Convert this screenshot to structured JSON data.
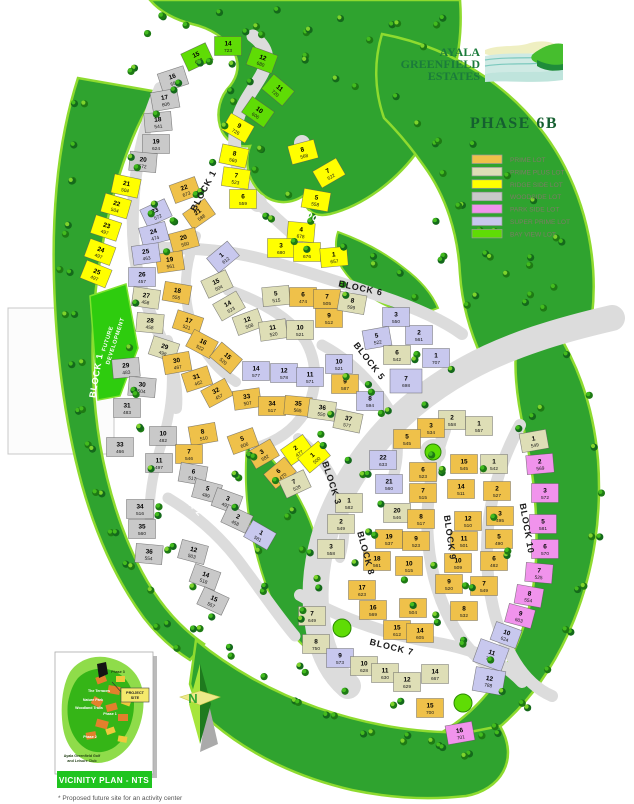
{
  "logo": {
    "line1": "AYALA",
    "line2": "GREENFIELD",
    "line3": "ESTATES"
  },
  "phase_title": "PHASE 6B",
  "legend": {
    "items": [
      {
        "key": "p",
        "label": "PRIME LOT",
        "color": "#EFC14A"
      },
      {
        "key": "pp",
        "label": "PRIME PLUS LOT",
        "color": "#DEDEB6"
      },
      {
        "key": "r",
        "label": "RIDGE SIDE LOT",
        "color": "#FFFF00"
      },
      {
        "key": "w",
        "label": "WOODSIDE LOT",
        "color": "#C9C9C9"
      },
      {
        "key": "pk",
        "label": "PARK SIDE LOT",
        "color": "#F193EC"
      },
      {
        "key": "sp",
        "label": "SUPER PRIME LOT",
        "color": "#C8C8EE"
      },
      {
        "key": "b",
        "label": "BAY VIEW LOT",
        "color": "#5FDC05"
      }
    ]
  },
  "compass": {
    "label": "N"
  },
  "footnote": "* Proposed future site for an activity center",
  "vicinity": {
    "banner": "VICINITY PLAN - NTS",
    "project_site_line1": "PROJECT",
    "project_site_line2": "SITE",
    "labels": [
      [
        "Phase 3",
        118,
        673,
        "#1d3a10"
      ],
      [
        "The Terraces",
        99,
        692,
        "#ffffff"
      ],
      [
        "Nature Park",
        93,
        701,
        "#ffffff"
      ],
      [
        "Woodland Trails",
        89,
        709,
        "#ffffff"
      ],
      [
        "Phase 1",
        110,
        715,
        "#ffffff"
      ],
      [
        "Phase 2",
        90,
        738,
        "#ffffff"
      ],
      [
        "Ayala Greenfield Golf",
        82,
        757,
        "#1d3a10"
      ],
      [
        "and Leisure Club",
        82,
        762,
        "#1d3a10"
      ]
    ]
  },
  "map": {
    "future_dev_line1": "FUTURE",
    "future_dev_line2": "DEVELOPMENT",
    "block_labels": [
      [
        "BLOCK 1",
        206,
        192,
        -62,
        "#1a1a1a"
      ],
      [
        "BLOCK 1",
        312,
        220,
        30,
        "#ffffff"
      ],
      [
        "BLOCK 1",
        99,
        376,
        -80,
        "#ffffff"
      ],
      [
        "BLOCK 6",
        360,
        291,
        12,
        "#1a1a1a"
      ],
      [
        "BLOCK 5",
        367,
        363,
        52,
        "#1a1a1a"
      ],
      [
        "BLOCK 2",
        184,
        500,
        48,
        "#ffffff"
      ],
      [
        "BLOCK 3",
        329,
        484,
        72,
        "#1a1a1a"
      ],
      [
        "BLOCK 8",
        363,
        554,
        75,
        "#1a1a1a"
      ],
      [
        "BLOCK 9",
        447,
        538,
        82,
        "#1a1a1a"
      ],
      [
        "BLOCK 10",
        524,
        529,
        80,
        "#1a1a1a"
      ],
      [
        "BLOCK 7",
        391,
        650,
        14,
        "#1a1a1a"
      ]
    ],
    "green_circle_lots": [
      [
        433,
        452,
        8
      ],
      [
        342,
        628,
        9
      ],
      [
        463,
        703,
        9
      ]
    ],
    "lots": [
      [
        "15",
        "688",
        "b",
        197,
        57,
        -25
      ],
      [
        "14",
        "723",
        "b",
        228,
        46,
        0
      ],
      [
        "12",
        "680",
        "b",
        262,
        60,
        20
      ],
      [
        "11",
        "720",
        "b",
        278,
        90,
        40
      ],
      [
        "10",
        "606",
        "b",
        258,
        112,
        35
      ],
      [
        "16",
        "680",
        "w",
        173,
        79,
        -18
      ],
      [
        "17",
        "606",
        "w",
        165,
        100,
        -10
      ],
      [
        "18",
        "541",
        "w",
        158,
        122,
        -5
      ],
      [
        "19",
        "624",
        "w",
        156,
        144,
        0
      ],
      [
        "20",
        "572",
        "w",
        143,
        162,
        5
      ],
      [
        "21",
        "504",
        "r",
        126,
        186,
        12
      ],
      [
        "22",
        "504",
        "r",
        116,
        206,
        16
      ],
      [
        "23",
        "497",
        "r",
        106,
        228,
        18
      ],
      [
        "24",
        "497",
        "r",
        100,
        252,
        20
      ],
      [
        "25",
        "497",
        "r",
        96,
        274,
        22
      ],
      [
        "9",
        "726",
        "r",
        238,
        128,
        30
      ],
      [
        "8",
        "569",
        "r",
        234,
        156,
        12
      ],
      [
        "7",
        "523",
        "r",
        236,
        178,
        8
      ],
      [
        "6",
        "559",
        "r",
        243,
        199,
        0
      ],
      [
        "8",
        "568",
        "r",
        303,
        152,
        -15
      ],
      [
        "7",
        "522",
        "r",
        329,
        173,
        -30
      ],
      [
        "5",
        "558",
        "r",
        316,
        200,
        10
      ],
      [
        "4",
        "678",
        "r",
        301,
        232,
        5
      ],
      [
        "3",
        "680",
        "r",
        281,
        248,
        0
      ],
      [
        "2",
        "676",
        "r",
        307,
        252,
        0
      ],
      [
        "1",
        "657",
        "r",
        334,
        257,
        -5
      ],
      [
        "22",
        "673",
        "p",
        185,
        190,
        -20
      ],
      [
        "21",
        "588",
        "p",
        199,
        214,
        -35
      ],
      [
        "20",
        "550",
        "p",
        184,
        240,
        -15
      ],
      [
        "19",
        "561",
        "p",
        170,
        262,
        -8
      ],
      [
        "18",
        "555",
        "p",
        177,
        293,
        10
      ],
      [
        "17",
        "521",
        "p",
        188,
        323,
        18
      ],
      [
        "16",
        "522",
        "p",
        202,
        344,
        28
      ],
      [
        "15",
        "520",
        "p",
        226,
        358,
        40
      ],
      [
        "23",
        "572",
        "sp",
        156,
        213,
        -25
      ],
      [
        "24",
        "474",
        "sp",
        154,
        234,
        -15
      ],
      [
        "25",
        "463",
        "sp",
        146,
        254,
        -8
      ],
      [
        "26",
        "457",
        "sp",
        142,
        277,
        0
      ],
      [
        "27",
        "458",
        "pp",
        146,
        298,
        8
      ],
      [
        "28",
        "458",
        "pp",
        150,
        323,
        5
      ],
      [
        "29",
        "498",
        "pp",
        164,
        349,
        18
      ],
      [
        "1",
        "612",
        "sp",
        223,
        257,
        -40
      ],
      [
        "15",
        "504",
        "pp",
        217,
        284,
        -25
      ],
      [
        "14",
        "523",
        "pp",
        229,
        306,
        -30
      ],
      [
        "12",
        "508",
        "pp",
        248,
        322,
        -20
      ],
      [
        "11",
        "520",
        "pp",
        273,
        330,
        -8
      ],
      [
        "10",
        "521",
        "pp",
        300,
        330,
        0
      ],
      [
        "5",
        "515",
        "pp",
        276,
        296,
        -5
      ],
      [
        "6",
        "474",
        "p",
        303,
        297,
        0
      ],
      [
        "7",
        "505",
        "p",
        327,
        299,
        0
      ],
      [
        "9",
        "512",
        "p",
        329,
        318,
        0
      ],
      [
        "8",
        "599",
        "pp",
        352,
        303,
        10
      ],
      [
        "30",
        "467",
        "p",
        177,
        363,
        -10
      ],
      [
        "31",
        "462",
        "p",
        197,
        379,
        -18
      ],
      [
        "32",
        "457",
        "p",
        217,
        393,
        -28
      ],
      [
        "33",
        "507",
        "p",
        247,
        399,
        -8
      ],
      [
        "34",
        "517",
        "p",
        272,
        406,
        0
      ],
      [
        "35",
        "565",
        "p",
        298,
        406,
        5
      ],
      [
        "36",
        "550",
        "pp",
        322,
        410,
        8
      ],
      [
        "37",
        "577",
        "pp",
        348,
        421,
        12
      ],
      [
        "14",
        "577",
        "sp",
        256,
        371,
        0
      ],
      [
        "12",
        "578",
        "sp",
        284,
        373,
        0
      ],
      [
        "11",
        "571",
        "sp",
        310,
        377,
        0
      ],
      [
        "29",
        "483",
        "w",
        126,
        368,
        -5
      ],
      [
        "30",
        "504",
        "w",
        142,
        387,
        5
      ],
      [
        "31",
        "483",
        "w",
        127,
        408,
        0
      ],
      [
        "33",
        "466",
        "w",
        120,
        447,
        0
      ],
      [
        "5",
        "522",
        "sp",
        377,
        338,
        -10
      ],
      [
        "2",
        "561",
        "sp",
        419,
        335,
        0
      ],
      [
        "6",
        "542",
        "pp",
        397,
        355,
        0
      ],
      [
        "1",
        "707",
        "sp",
        436,
        358,
        0
      ],
      [
        "10",
        "521",
        "sp",
        339,
        364,
        0
      ],
      [
        "9",
        "587",
        "p",
        345,
        384,
        0
      ],
      [
        "7",
        "698",
        "sp",
        406,
        381,
        0,
        32,
        24
      ],
      [
        "8",
        "594",
        "sp",
        370,
        401,
        0
      ],
      [
        "3",
        "550",
        "sp",
        396,
        317,
        0
      ],
      [
        "2",
        "558",
        "pp",
        452,
        420,
        0
      ],
      [
        "1",
        "557",
        "pp",
        479,
        426,
        0
      ],
      [
        "10",
        "482",
        "w",
        163,
        436,
        0
      ],
      [
        "8",
        "510",
        "p",
        203,
        434,
        -10
      ],
      [
        "7",
        "546",
        "p",
        189,
        454,
        0
      ],
      [
        "11",
        "497",
        "w",
        159,
        463,
        0
      ],
      [
        "6",
        "517",
        "w",
        193,
        474,
        10
      ],
      [
        "5",
        "489",
        "w",
        207,
        491,
        15
      ],
      [
        "3",
        "492",
        "w",
        227,
        501,
        20
      ],
      [
        "2",
        "458",
        "w",
        237,
        519,
        25
      ],
      [
        "1",
        "581",
        "sp",
        260,
        535,
        30
      ],
      [
        "34",
        "516",
        "w",
        140,
        509,
        0
      ],
      [
        "35",
        "560",
        "w",
        142,
        529,
        0
      ],
      [
        "36",
        "554",
        "w",
        149,
        554,
        5
      ],
      [
        "12",
        "503",
        "w",
        193,
        552,
        15
      ],
      [
        "14",
        "518",
        "w",
        205,
        577,
        20
      ],
      [
        "15",
        "557",
        "w",
        213,
        601,
        25
      ],
      [
        "5",
        "606",
        "p",
        243,
        441,
        -20
      ],
      [
        "3",
        "582",
        "p",
        263,
        454,
        -30
      ],
      [
        "6",
        "470",
        "p",
        280,
        473,
        -40
      ],
      [
        "2",
        "477",
        "r",
        297,
        450,
        -35
      ],
      [
        "1",
        "500",
        "r",
        314,
        457,
        -40
      ],
      [
        "7",
        "528",
        "pp",
        295,
        484,
        -25
      ],
      [
        "1",
        "582",
        "pp",
        349,
        503,
        0
      ],
      [
        "2",
        "549",
        "pp",
        341,
        524,
        0
      ],
      [
        "3",
        "558",
        "pp",
        331,
        549,
        0
      ],
      [
        "22",
        "633",
        "sp",
        383,
        460,
        0
      ],
      [
        "21",
        "560",
        "sp",
        389,
        484,
        0
      ],
      [
        "20",
        "546",
        "pp",
        397,
        513,
        0
      ],
      [
        "19",
        "537",
        "p",
        389,
        539,
        0
      ],
      [
        "18",
        "561",
        "p",
        377,
        561,
        0
      ],
      [
        "17",
        "623",
        "p",
        362,
        590,
        0
      ],
      [
        "3",
        "534",
        "p",
        431,
        428,
        0
      ],
      [
        "5",
        "545",
        "p",
        407,
        439,
        0
      ],
      [
        "6",
        "523",
        "p",
        423,
        472,
        0
      ],
      [
        "7",
        "515",
        "p",
        423,
        493,
        0
      ],
      [
        "8",
        "517",
        "p",
        421,
        519,
        0
      ],
      [
        "9",
        "523",
        "p",
        416,
        541,
        0
      ],
      [
        "10",
        "515",
        "p",
        409,
        566,
        0
      ],
      [
        "15",
        "545",
        "p",
        464,
        464,
        0
      ],
      [
        "1",
        "542",
        "pp",
        494,
        464,
        0
      ],
      [
        "2",
        "527",
        "p",
        497,
        491,
        0
      ],
      [
        "14",
        "511",
        "p",
        461,
        489,
        0
      ],
      [
        "3",
        "495",
        "p",
        500,
        516,
        0
      ],
      [
        "12",
        "510",
        "p",
        468,
        521,
        0
      ],
      [
        "5",
        "490",
        "p",
        499,
        539,
        0
      ],
      [
        "11",
        "501",
        "p",
        464,
        541,
        0
      ],
      [
        "6",
        "482",
        "p",
        494,
        561,
        0
      ],
      [
        "10",
        "509",
        "p",
        458,
        563,
        0
      ],
      [
        "7",
        "549",
        "p",
        484,
        586,
        0
      ],
      [
        "9",
        "520",
        "p",
        449,
        584,
        0
      ],
      [
        "8",
        "532",
        "p",
        464,
        611,
        0
      ],
      [
        "1",
        "549",
        "pp",
        534,
        441,
        -10
      ],
      [
        "2",
        "569",
        "pk",
        540,
        464,
        -5
      ],
      [
        "3",
        "572",
        "pk",
        545,
        493,
        0
      ],
      [
        "5",
        "581",
        "pk",
        543,
        524,
        0
      ],
      [
        "6",
        "570",
        "pk",
        545,
        549,
        0
      ],
      [
        "7",
        "525",
        "pk",
        539,
        573,
        5
      ],
      [
        "8",
        "554",
        "pk",
        529,
        596,
        10
      ],
      [
        "9",
        "603",
        "pk",
        520,
        616,
        15
      ],
      [
        "10",
        "624",
        "sp",
        506,
        635,
        20
      ],
      [
        "11",
        "794",
        "sp",
        491,
        655,
        20,
        30,
        24
      ],
      [
        "12",
        "788",
        "sp",
        489,
        681,
        10,
        30,
        24
      ],
      [
        "16",
        "701",
        "pk",
        460,
        733,
        -10
      ],
      [
        "16",
        "569",
        "p",
        373,
        610,
        0
      ],
      [
        "12",
        "504",
        "p",
        413,
        608,
        0
      ],
      [
        "15",
        "612",
        "p",
        397,
        630,
        0
      ],
      [
        "14",
        "605",
        "p",
        420,
        633,
        0
      ],
      [
        "7",
        "649",
        "pp",
        312,
        616,
        0
      ],
      [
        "8",
        "750",
        "pp",
        316,
        644,
        0
      ],
      [
        "9",
        "573",
        "sp",
        340,
        658,
        0
      ],
      [
        "10",
        "628",
        "pp",
        364,
        666,
        0
      ],
      [
        "11",
        "630",
        "pp",
        385,
        673,
        0
      ],
      [
        "12",
        "629",
        "pp",
        407,
        682,
        0
      ],
      [
        "14",
        "667",
        "pp",
        435,
        674,
        0
      ],
      [
        "15",
        "700",
        "p",
        430,
        708,
        0
      ]
    ]
  }
}
